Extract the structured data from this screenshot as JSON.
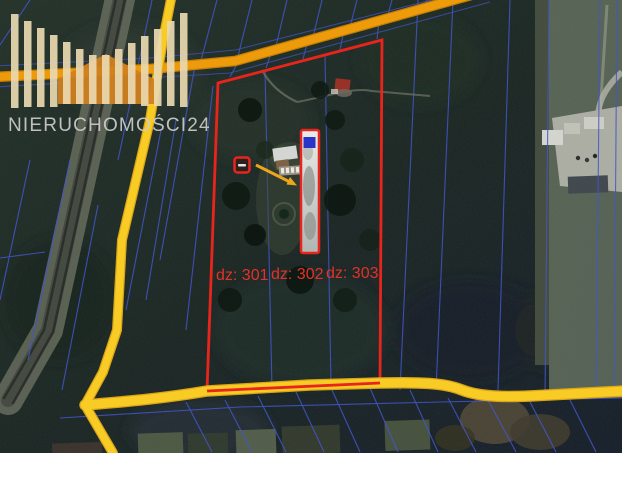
{
  "watermark": {
    "brand": "NIERUCHOMOŚCI24"
  },
  "parcel_labels": [
    "dz: 301",
    "dz: 302",
    "dz: 303"
  ],
  "map": {
    "kind": "satellite-cadastral-map",
    "colors": {
      "boundary_red": "#e8251d",
      "label_red": "#e43127",
      "cadastral_blue": "#4356cb",
      "road_orange": "#ee9b0b",
      "road_orange_edge": "#c47d06",
      "road_yellow": "#f9cb25",
      "road_yellow_edge": "#d9a518",
      "arrow_orange": "#eda61c",
      "blue_roof": "#2a35c8",
      "logo_cream": "#ead9b0",
      "logo_orange": "#cf7f1f",
      "logo_text": "#cdcdcd"
    }
  }
}
